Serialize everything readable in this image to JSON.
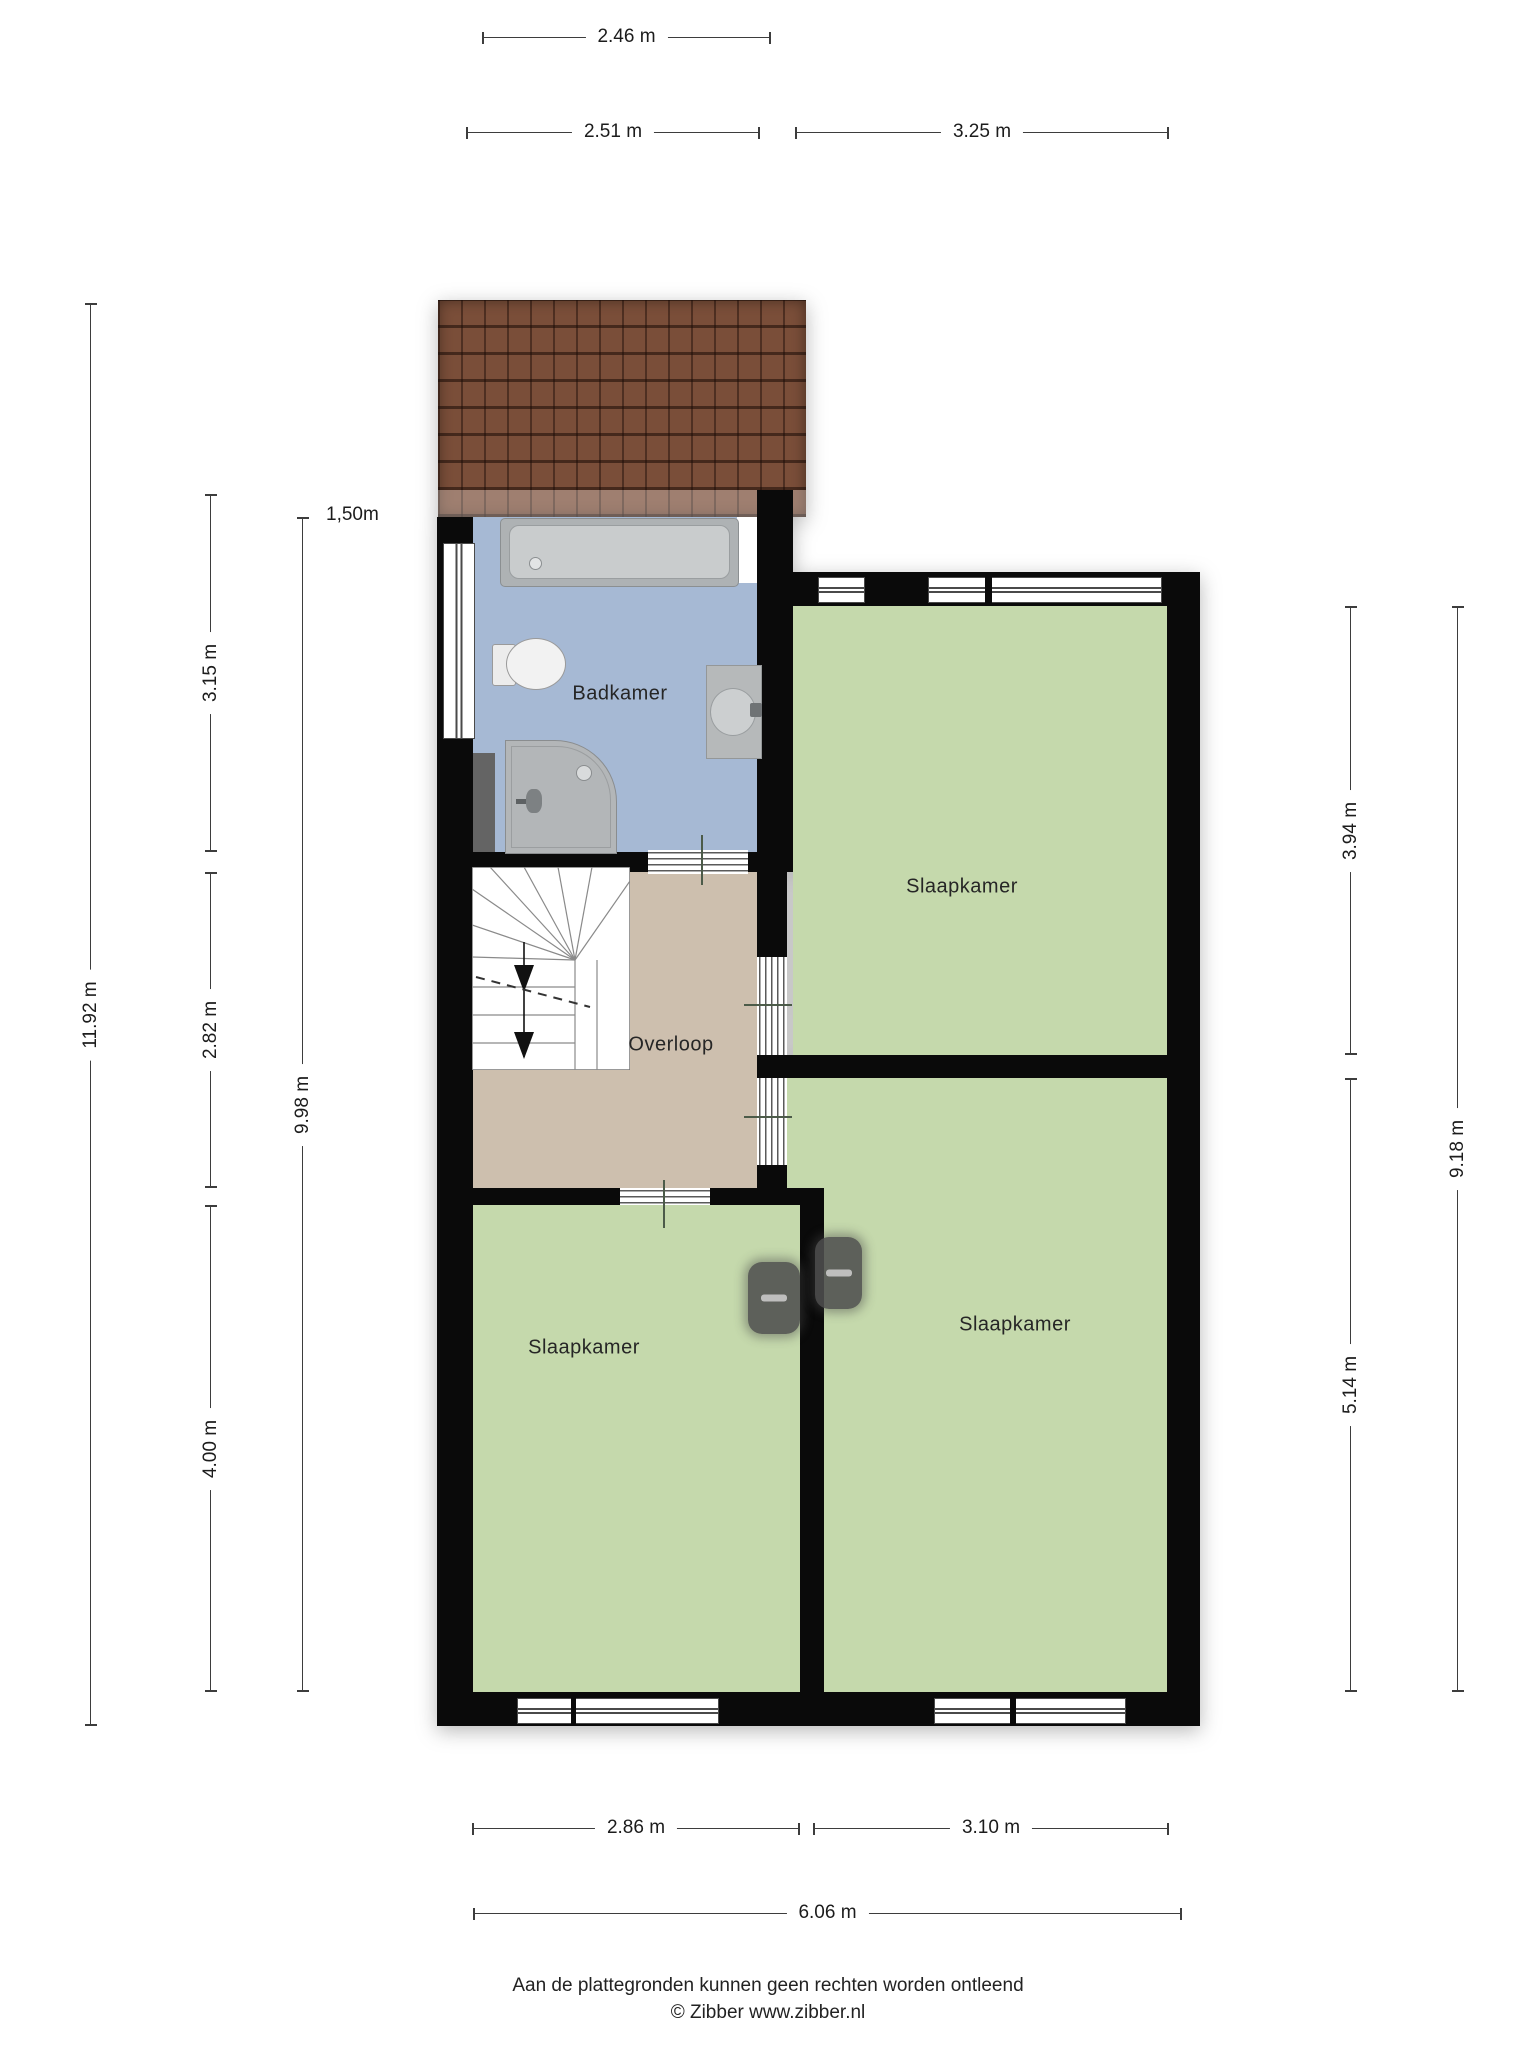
{
  "rooms": {
    "bathroom": "Badkamer",
    "landing": "Overloop",
    "bedroom": "Slaapkamer"
  },
  "annotations": {
    "knee_wall_height": "1,50m"
  },
  "dimensions": {
    "roof_width": "2.46 m",
    "bathroom_width": "2.51 m",
    "bedroom_tr_width": "3.25 m",
    "total_height": "11.92 m",
    "bathroom_height": "3.15 m",
    "landing_height": "2.82 m",
    "bedroom_bl_height": "4.00 m",
    "left_interior_height": "9.98 m",
    "bedroom_tr_height": "3.94 m",
    "bedroom_br_height": "5.14 m",
    "right_interior_height": "9.18 m",
    "bedroom_bl_width": "2.86 m",
    "bedroom_br_width": "3.10 m",
    "total_width": "6.06 m"
  },
  "footer": {
    "disclaimer": "Aan de plattegronden kunnen geen rechten worden ontleend",
    "credit": "© Zibber www.zibber.nl"
  },
  "colors": {
    "wall": "#0a0a0a",
    "bedroom_floor": "#c5d9ac",
    "bathroom_floor": "#a6b9d4",
    "landing_floor": "#cdbfae",
    "roof_tile": "#7a4e39"
  }
}
